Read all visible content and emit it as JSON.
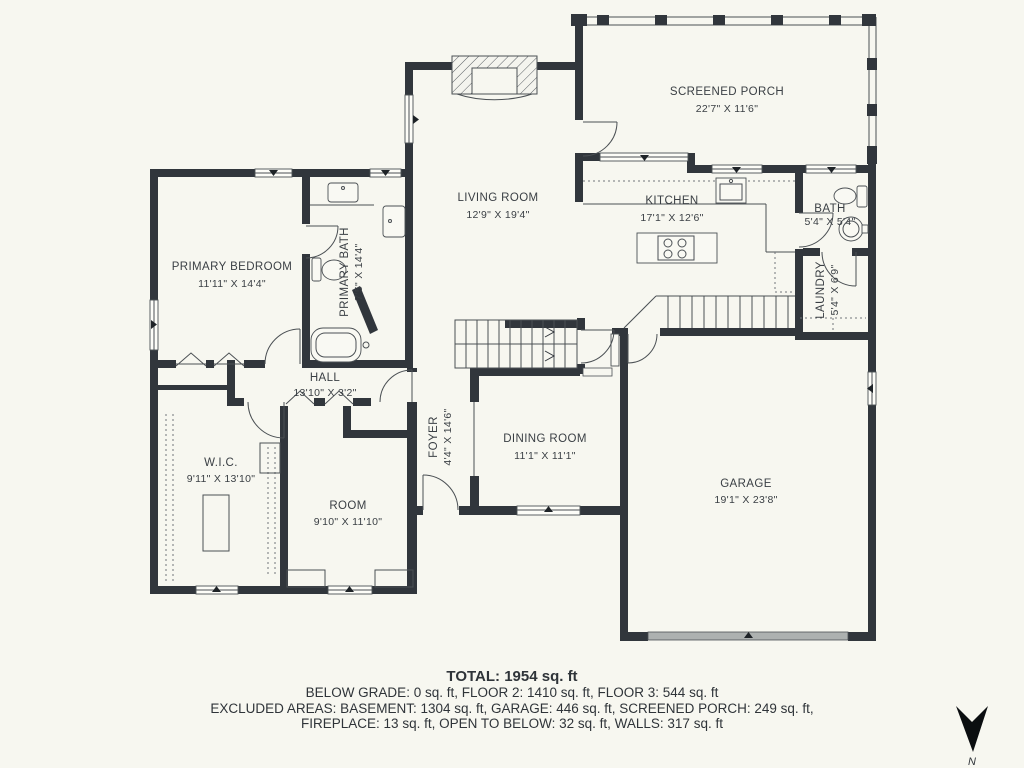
{
  "plan": {
    "rooms": {
      "screened_porch": {
        "name": "SCREENED PORCH",
        "dims": "22'7\" X 11'6\""
      },
      "living_room": {
        "name": "LIVING ROOM",
        "dims": "12'9\" X 19'4\""
      },
      "kitchen": {
        "name": "KITCHEN",
        "dims": "17'1\" X 12'6\""
      },
      "bath": {
        "name": "BATH",
        "dims": "5'4\" X 5'4\""
      },
      "laundry": {
        "name": "LAUNDRY",
        "dims": "5'4\" X 6'9\""
      },
      "primary_bedroom": {
        "name": "PRIMARY BEDROOM",
        "dims": "11'11\" X 14'4\""
      },
      "primary_bath": {
        "name": "PRIMARY BATH",
        "dims": "7'5\" X 14'4\""
      },
      "hall": {
        "name": "HALL",
        "dims": "13'10\" X 3'2\""
      },
      "foyer": {
        "name": "FOYER",
        "dims": "4'4\" X 14'6\""
      },
      "dining_room": {
        "name": "DINING ROOM",
        "dims": "11'1\" X 11'1\""
      },
      "wic": {
        "name": "W.I.C.",
        "dims": "9'11\" X 13'10\""
      },
      "room": {
        "name": "ROOM",
        "dims": "9'10\" X 11'10\""
      },
      "garage": {
        "name": "GARAGE",
        "dims": "19'1\" X 23'8\""
      }
    },
    "summary": {
      "total": "TOTAL: 1954 sq. ft",
      "line1": "BELOW GRADE: 0 sq. ft, FLOOR 2: 1410 sq. ft, FLOOR 3: 544 sq. ft",
      "line2": "EXCLUDED AREAS: BASEMENT: 1304 sq. ft, GARAGE: 446 sq. ft, SCREENED PORCH: 249 sq. ft,",
      "line3": "FIREPLACE: 13 sq. ft, OPEN TO BELOW: 32 sq. ft, WALLS: 317 sq. ft"
    },
    "compass": {
      "label": "N"
    },
    "colors": {
      "wall": "#31363C",
      "background": "#F7F7F0",
      "text": "#3A3F44",
      "garage_door": "#ADB1B0"
    }
  }
}
